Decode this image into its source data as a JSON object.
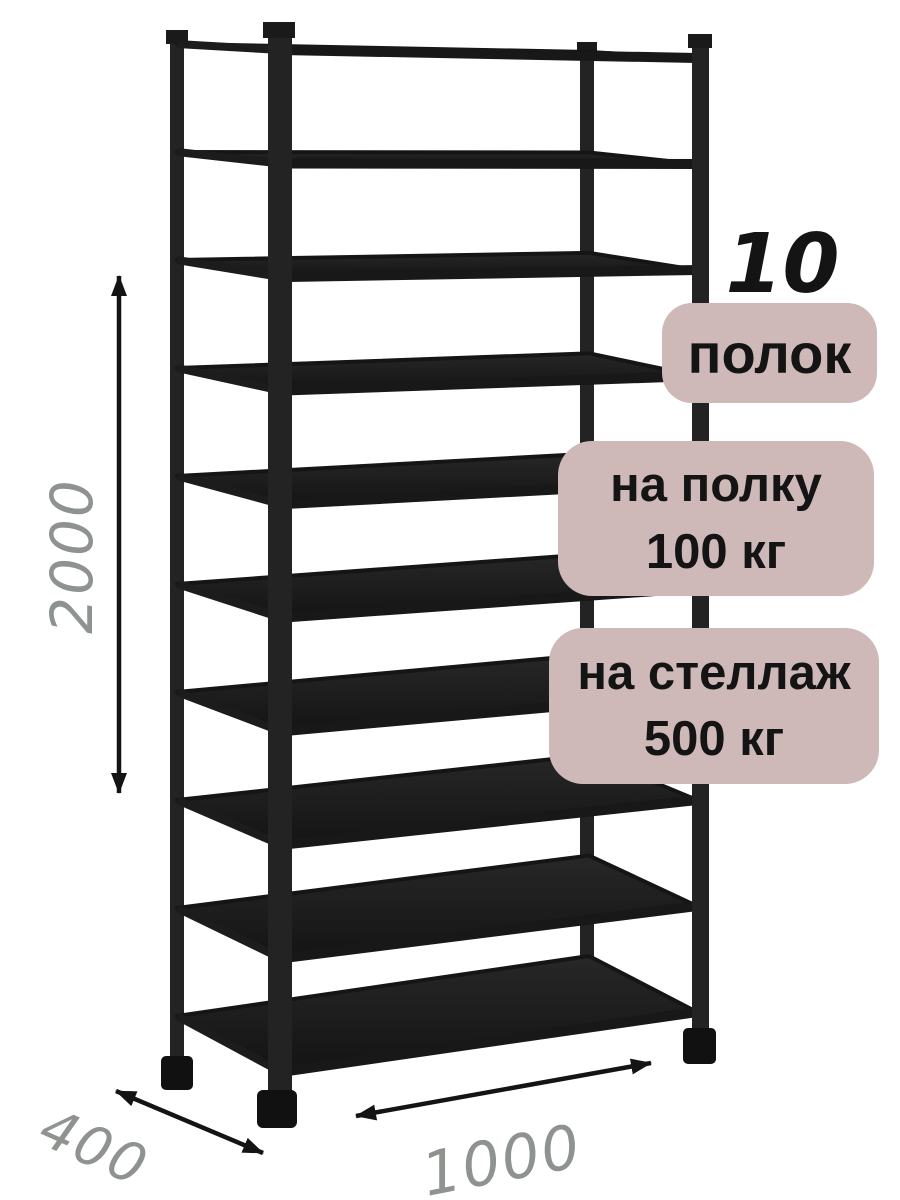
{
  "product": {
    "shelf_count": "10",
    "shelf_count_unit": "полок",
    "per_shelf_load": {
      "line1": "на полку",
      "line2": "100 кг"
    },
    "per_rack_load": {
      "line1": "на стеллаж",
      "line2": "500 кг"
    }
  },
  "dimensions": {
    "height_mm": "2000",
    "depth_mm": "400",
    "width_mm": "1000"
  },
  "rack": {
    "shelf_count": 10,
    "color": "#1b1b1b"
  },
  "colors": {
    "badge_bg": "#ceb8b8",
    "badge_text": "#141414",
    "dimension_text": "#8f938f",
    "arrow": "#141414",
    "background": "#ffffff"
  }
}
